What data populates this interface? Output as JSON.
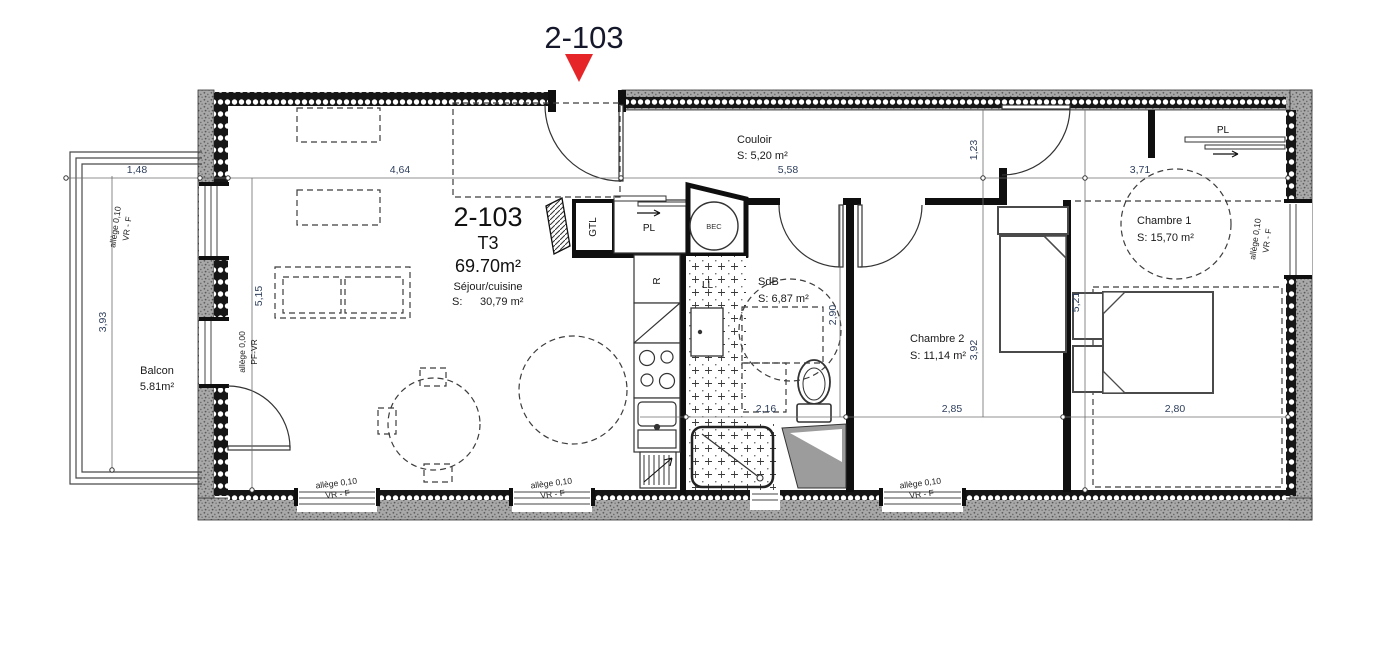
{
  "colors": {
    "accent_red": "#e52528",
    "dim_text": "#2e3f5c",
    "title_text": "#15182b",
    "wall_black": "#0f0f0f",
    "stipple_gray": "#a8a8a8"
  },
  "header": {
    "unit": "2-103"
  },
  "rooms": {
    "sejour": {
      "unit": "2-103",
      "type": "T3",
      "total_area": "69.70m²",
      "name": "Séjour/cuisine",
      "area_prefix": "S:",
      "area": "30,79 m²"
    },
    "couloir": {
      "name": "Couloir",
      "area": "S: 5,20 m²"
    },
    "sdb": {
      "name": "SdB",
      "area": "S: 6,87 m²"
    },
    "chambre2": {
      "name": "Chambre 2",
      "area": "S: 11,14 m²"
    },
    "chambre1": {
      "name": "Chambre 1",
      "area": "S: 15,70 m²"
    },
    "balcon": {
      "name": "Balcon",
      "area": "5.81m²"
    }
  },
  "dims": {
    "w_balcon": "1,48",
    "w_sejour": "4,64",
    "w_couloir": "5,58",
    "w_chambre1_top": "3,71",
    "h_balcon": "3,93",
    "h_sejour": "5,15",
    "h_entry": "1,23",
    "h_sdb": "2,90",
    "h_chambre2": "3,92",
    "h_chambre1": "5,21",
    "w_sdb": "2,16",
    "w_chambre2": "2,85",
    "w_chambre1": "2,80"
  },
  "fixtures": {
    "gtl": "GTL",
    "pl_entry": "PL",
    "bec": "BEC",
    "fridge": "R",
    "washer": "LL",
    "pl_chambre1": "PL"
  },
  "openings": {
    "allege_010": "allège  0,10",
    "vrf": "VR - F",
    "allege_000": "allège 0,00",
    "pfvr": "PF-VR"
  }
}
